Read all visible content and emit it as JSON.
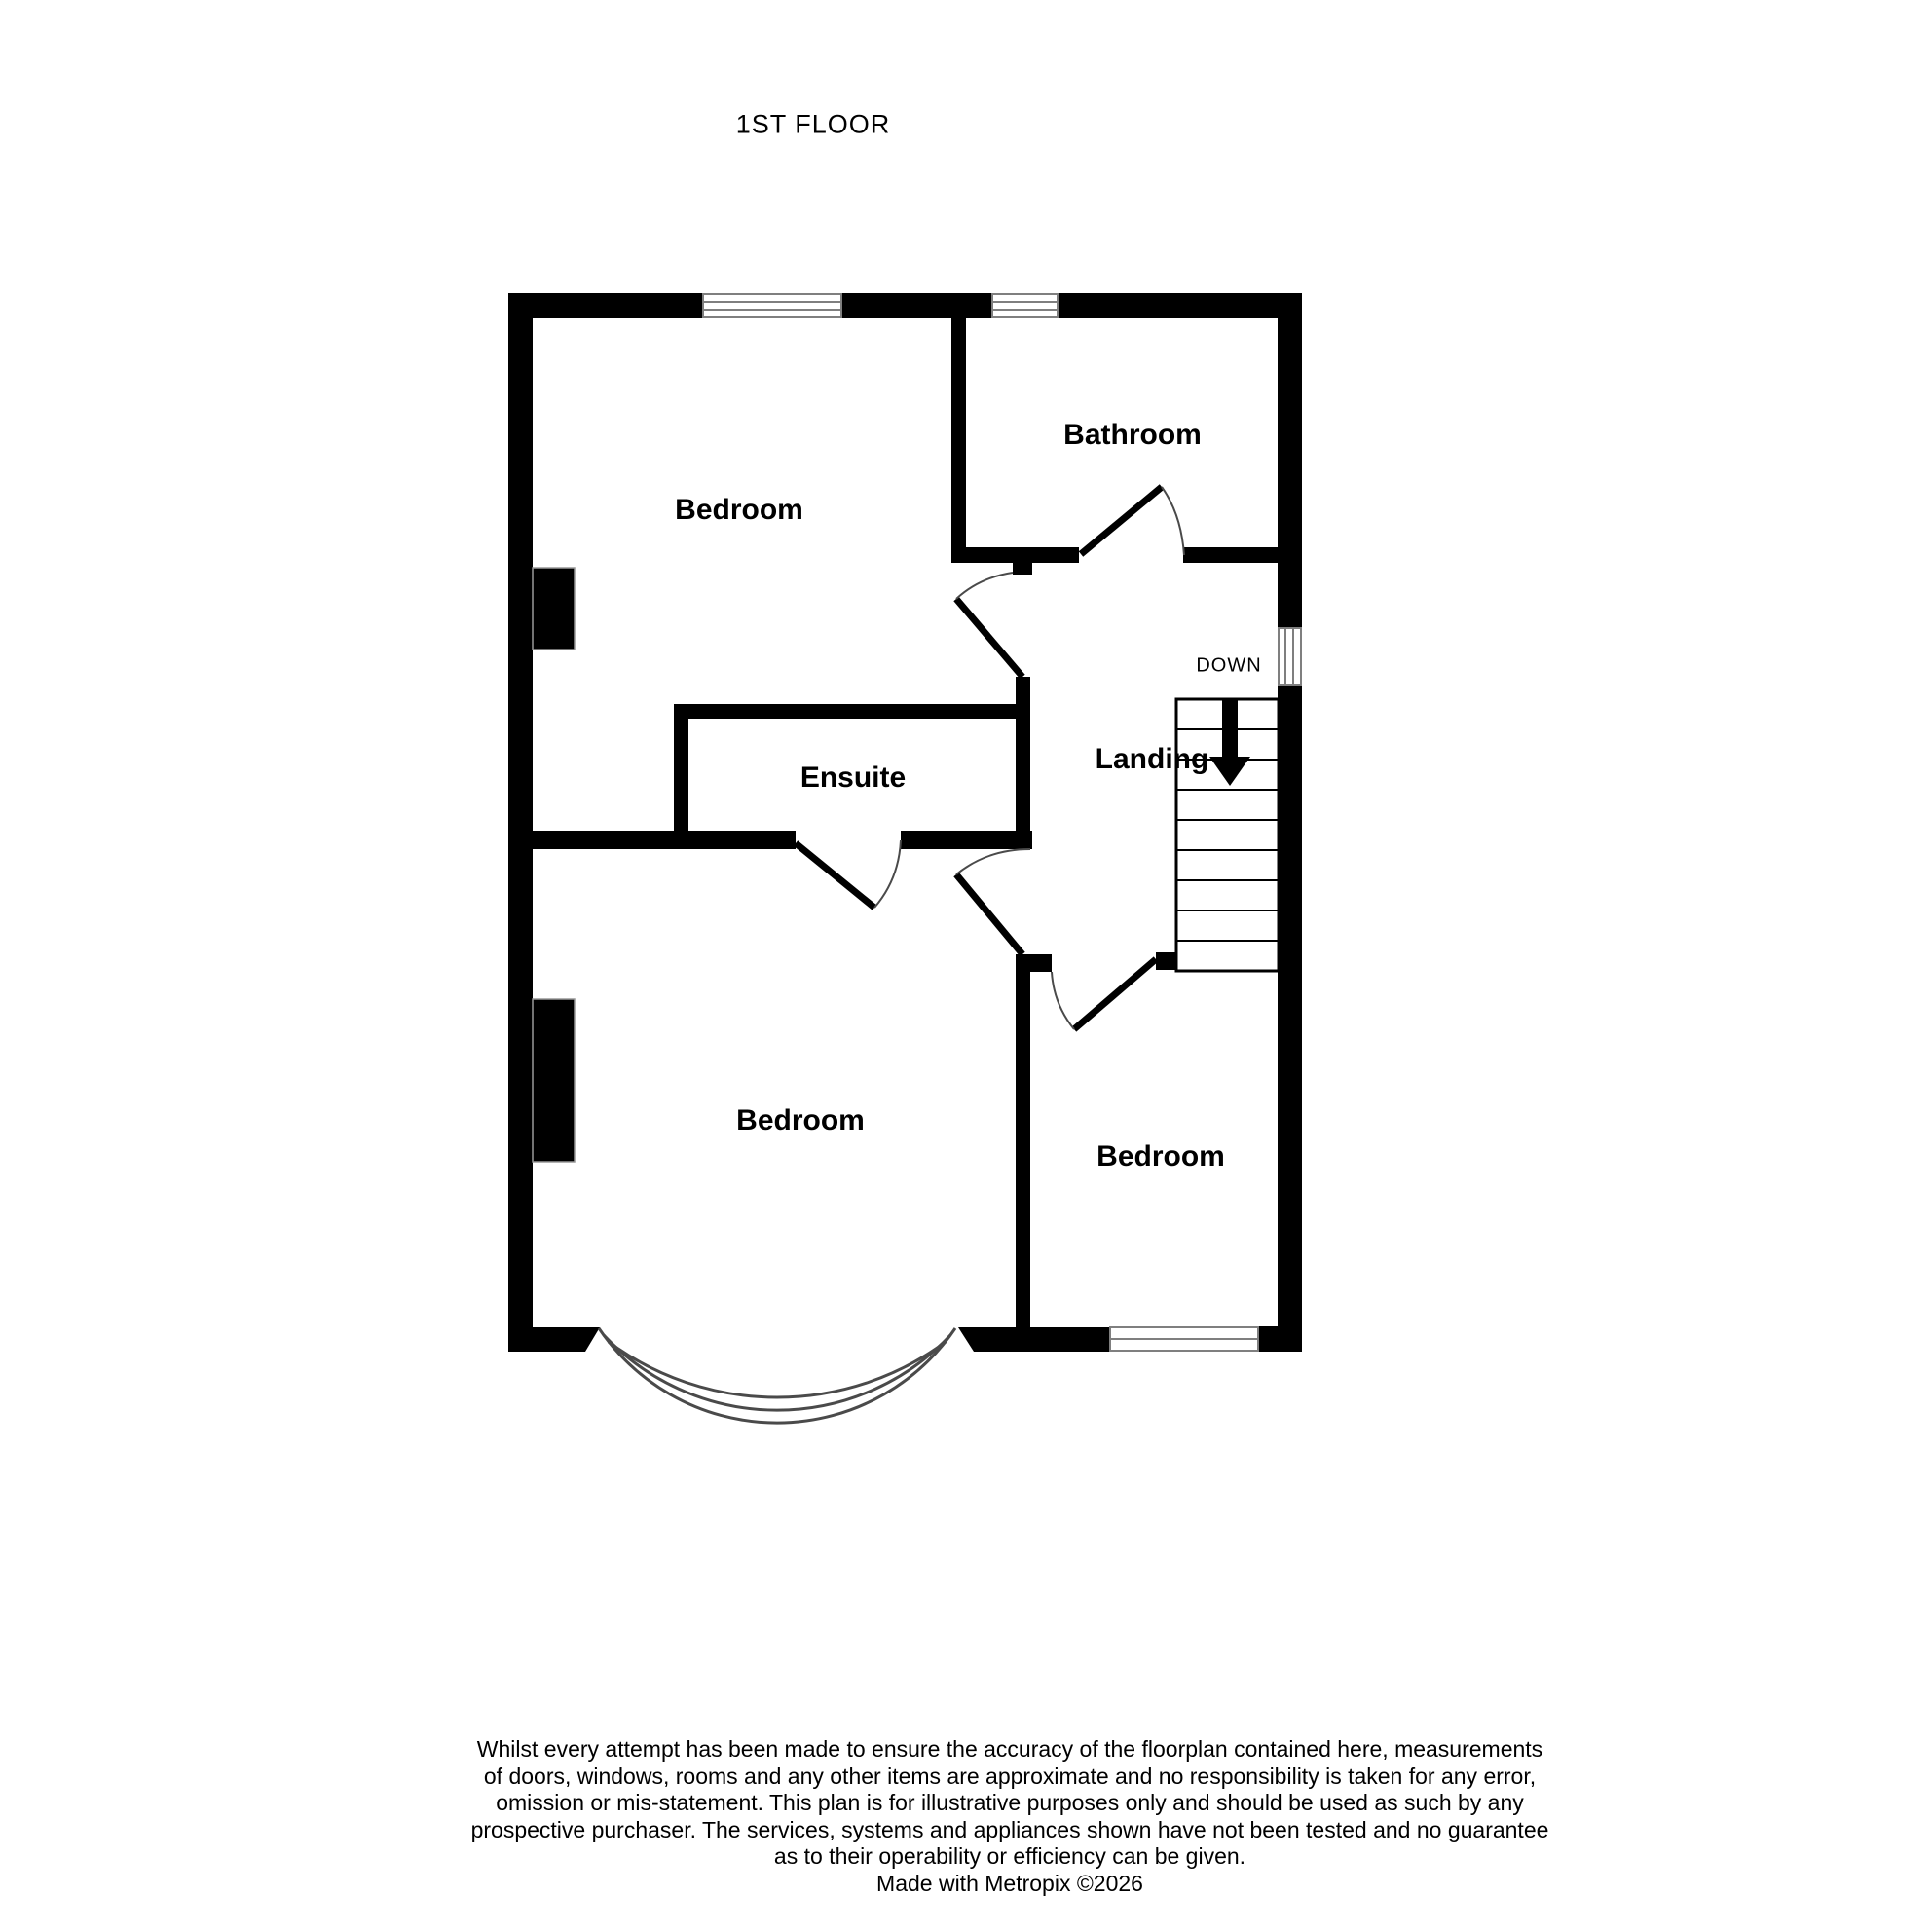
{
  "title": "1ST FLOOR",
  "colors": {
    "wall": "#000000",
    "window_frame": "#7f7f7f",
    "arc_line": "#4a4a4a",
    "stair_line": "#000000"
  },
  "rooms": [
    {
      "id": "bedroom-top",
      "label": "Bedroom"
    },
    {
      "id": "bathroom",
      "label": "Bathroom"
    },
    {
      "id": "ensuite",
      "label": "Ensuite"
    },
    {
      "id": "landing",
      "label": "Landing"
    },
    {
      "id": "bedroom-bottom-left",
      "label": "Bedroom"
    },
    {
      "id": "bedroom-bottom-right",
      "label": "Bedroom"
    }
  ],
  "stairs": {
    "direction_label": "DOWN"
  },
  "disclaimer": {
    "lines": [
      "Whilst every attempt has been made to ensure the accuracy of the floorplan contained here, measurements",
      "of doors, windows, rooms and any other items are approximate and no responsibility is taken for any error,",
      "omission or mis-statement. This plan is for illustrative purposes only and should be used as such by any",
      "prospective purchaser. The services, systems and appliances shown have not been tested and no guarantee",
      "as to their operability or efficiency can be given."
    ]
  },
  "credit": "Made with Metropix ©2026"
}
